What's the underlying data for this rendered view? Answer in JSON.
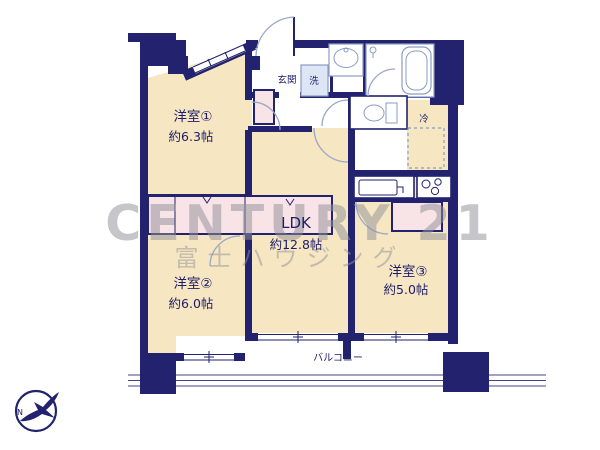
{
  "floor_plan": {
    "rooms": {
      "room1": {
        "name": "洋室①",
        "size": "約6.3帖"
      },
      "room2": {
        "name": "洋室②",
        "size": "約6.0帖"
      },
      "room3": {
        "name": "洋室③",
        "size": "約5.0帖"
      },
      "ldk": {
        "name": "LDK",
        "size": "約12.8帖"
      },
      "entrance": {
        "label": "玄関"
      },
      "laundry": {
        "label": "洗"
      },
      "fridge": {
        "label": "冷"
      },
      "balcony": {
        "label": "バルコニー"
      }
    },
    "compass": {
      "north_label": "N"
    },
    "watermark": {
      "brand": "CENTURY 21",
      "company": "富士ハウジング"
    },
    "colors": {
      "wall": "#22226e",
      "room_fill": "#f6e6c1",
      "closet_fill": "#f8e3e6",
      "fixture_stroke": "#8a9cc4",
      "watermark_gray": "#92929b"
    }
  }
}
